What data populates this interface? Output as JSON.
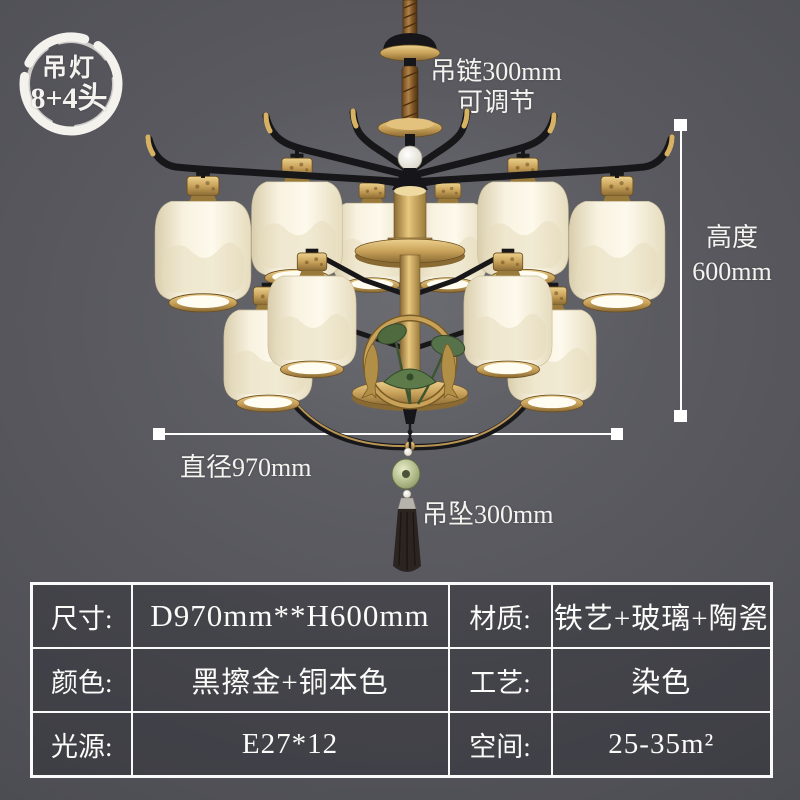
{
  "badge": {
    "line1": "吊灯",
    "line2": "8+4头"
  },
  "annotations": {
    "chain": "吊链300mm",
    "chain_sub": "可调节",
    "height_label": "高度",
    "height_value": "600mm",
    "diameter": "直径970mm",
    "drop": "吊坠300mm"
  },
  "spec_table": {
    "rows": [
      {
        "label1": "尺寸:",
        "value1": "D970mm**H600mm",
        "label2": "材质:",
        "value2": "铁艺+玻璃+陶瓷"
      },
      {
        "label1": "颜色:",
        "value1": "黑擦金+铜本色",
        "label2": "工艺:",
        "value2": "染色"
      },
      {
        "label1": "光源:",
        "value1": "E27*12",
        "label2": "空间:",
        "value2": "25-35m²"
      }
    ]
  },
  "colors": {
    "background": "#56565c",
    "gold": "#c9a25a",
    "black_iron": "#17171a",
    "lantern_cream": "#f6efdb",
    "leaf_green": "#4e6a3e",
    "dimension_line": "#ffffff",
    "text": "#f5f5f5"
  }
}
